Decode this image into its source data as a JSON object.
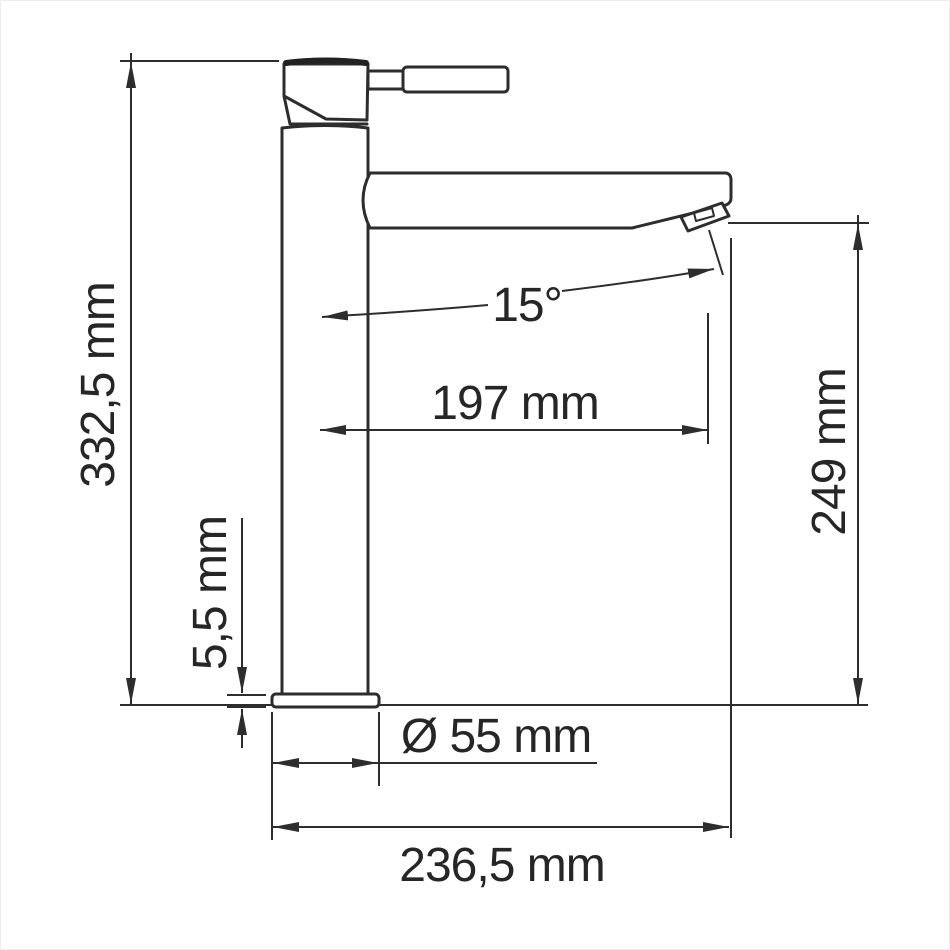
{
  "drawing": {
    "type": "faucet-technical-dimension-drawing",
    "labels": {
      "total_height": "332,5 mm",
      "base_plate_thickness": "5,5 mm",
      "spout_angle": "15°",
      "spout_reach": "197 mm",
      "spout_outlet_height": "249 mm",
      "base_diameter": "Ø 55 mm",
      "total_depth": "236,5 mm"
    },
    "colors": {
      "line": "#2d2d2d",
      "background": "#ffffff"
    }
  }
}
